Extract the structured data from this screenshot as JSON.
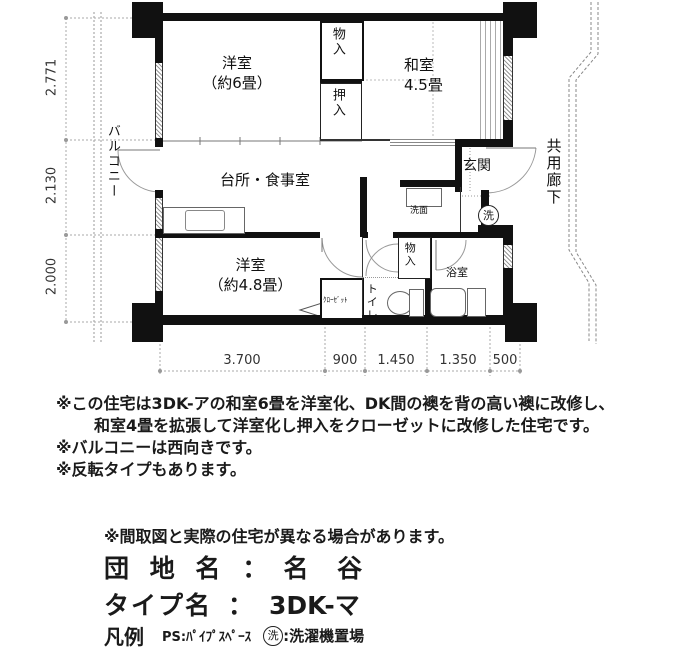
{
  "colors": {
    "wall": "#111111",
    "dim_line": "#999999",
    "text": "#1a1a1a"
  },
  "plan": {
    "rooms": {
      "yoshitsu6": {
        "l1": "洋室",
        "l2": "（約6畳）"
      },
      "mono_top": "物入",
      "oshiire": "押入",
      "washitsu": {
        "l1": "和室",
        "l2": "4.5畳"
      },
      "balcony": "バルコニー",
      "dk": "台所・食事室",
      "genkan": "玄関",
      "corridor": "共用廊下",
      "senmen": "洗面",
      "laundry_mark": "洗",
      "yoshitsu48": {
        "l1": "洋室",
        "l2": "（約4.8畳）"
      },
      "closet": "ｸﾛｰｾﾞｯﾄ",
      "toilet": "トイレ",
      "mono_bottom": "物入",
      "bath": "浴室"
    },
    "dims": {
      "left": [
        "2.771",
        "2.130",
        "2.000"
      ],
      "bottom": [
        "3.700",
        "900",
        "1.450",
        "1.350",
        "500"
      ]
    }
  },
  "notes": [
    "※この住宅は3DK-アの和室6畳を洋室化、DK間の襖を背の高い襖に改修し、",
    "和室4畳を拡張して洋室化し押入をクローゼットに改修した住宅です。",
    "※バルコニーは西向きです。",
    "※反転タイプもあります。"
  ],
  "disclaimer": "※間取図と実際の住宅が異なる場合があります。",
  "info": {
    "estate_label": "団 地 名",
    "estate_colon": "：",
    "estate_value": "名 谷",
    "type_label": "タイプ名",
    "type_colon": "：",
    "type_value": "3DK-マ"
  },
  "legend": {
    "title": "凡例",
    "ps": "PS:ﾊﾟｲﾌﾟｽﾍﾟｰｽ",
    "laundry_mark": "洗",
    "laundry_text": ":洗濯機置場"
  }
}
